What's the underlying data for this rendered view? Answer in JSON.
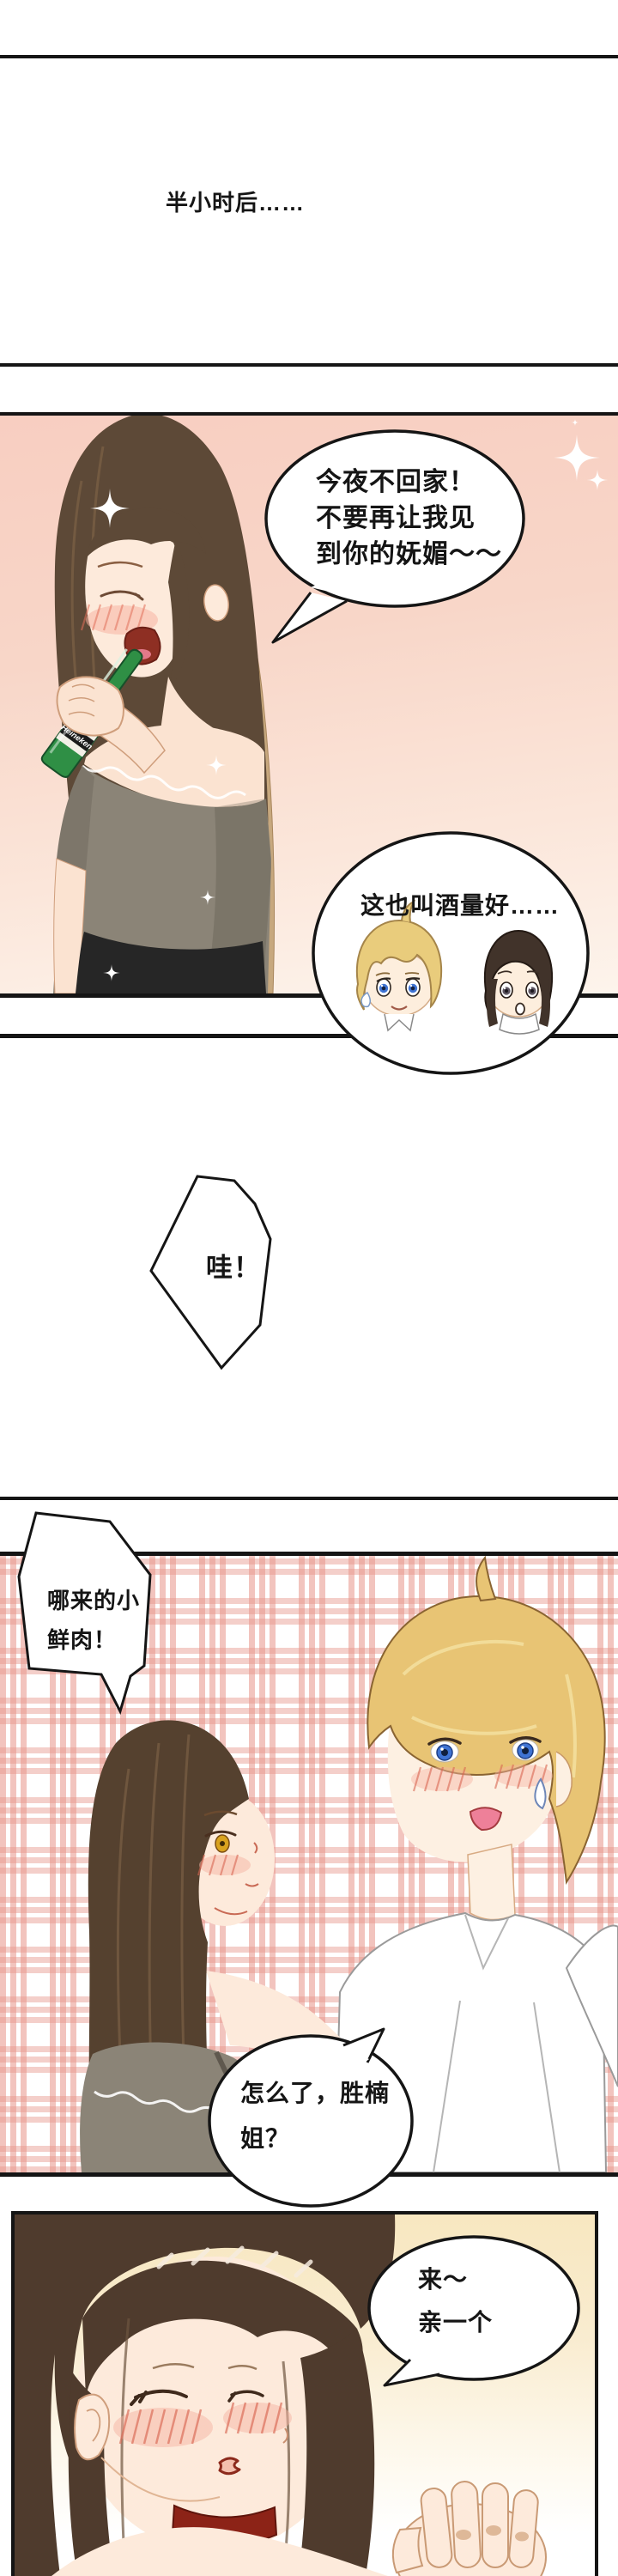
{
  "page": {
    "bg": "#ffffff"
  },
  "narration": {
    "text": "半小时后……"
  },
  "panel1": {
    "bg_top": "#f8cec1",
    "bg_bottom": "#fdf4ec",
    "bubble_main": {
      "line1": "今夜不回家！",
      "line2": "不要再让我见",
      "line3": "到你的妩媚～～"
    },
    "bubble_observers": {
      "text": "这也叫酒量好……"
    },
    "bottle": {
      "brand": "Heineken",
      "color": "#2f8f45"
    }
  },
  "interjection": {
    "text": "哇！"
  },
  "panel2": {
    "plaid_color": "#e7948a",
    "bubble_shout": {
      "line1": "哪来的小",
      "line2": "鲜肉！"
    },
    "bubble_reply": {
      "line1": "怎么了，胜楠",
      "line2": "姐？"
    }
  },
  "panel3": {
    "bg": "#f8e7c0",
    "bubble_kiss": {
      "line1": "来～",
      "line2": "亲一个"
    }
  }
}
